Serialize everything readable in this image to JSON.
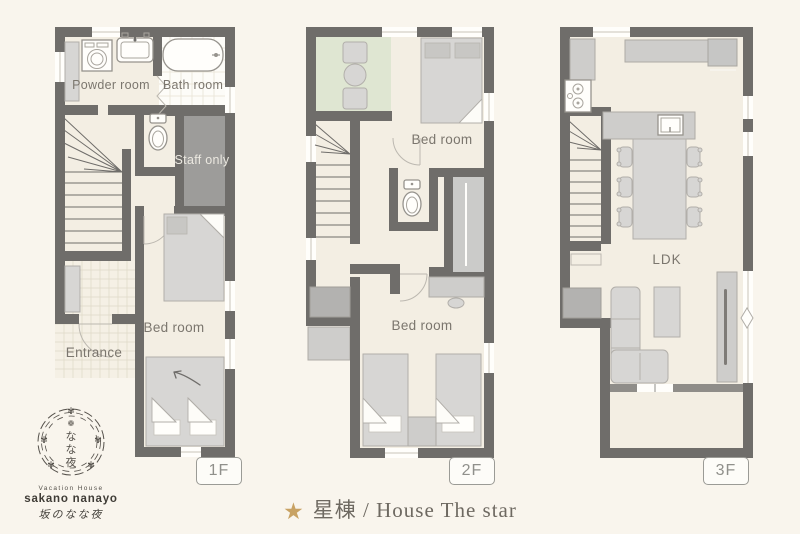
{
  "background": "#f9f5ed",
  "palette": {
    "wall": "#6f6d6a",
    "floor": "#f3eee3",
    "tatami_green": "#dfe6d2",
    "staff_room_gray": "#9d9c9a",
    "furniture_gray": "#d7d6d4",
    "accent_gold": "#c8a263",
    "label_text": "#7b766e"
  },
  "floors": [
    {
      "tag": "1F",
      "labels": {
        "powder": "Powder room",
        "bath": "Bath room",
        "staff": "Staff only",
        "bedroom": "Bed room",
        "entrance": "Entrance"
      }
    },
    {
      "tag": "2F",
      "labels": {
        "bedroom_upper": "Bed room",
        "bedroom_lower": "Bed room"
      }
    },
    {
      "tag": "3F",
      "labels": {
        "ldk": "LDK"
      }
    }
  ],
  "footer": {
    "star": "★",
    "title": "星棟 / House The star"
  },
  "logo": {
    "flower": "❁",
    "petal": "✾",
    "char1": "な",
    "char2": "な",
    "char3": "夜",
    "line1": "Vacation House",
    "line2": "sakano nanayo",
    "line3": "坂のなな夜"
  }
}
